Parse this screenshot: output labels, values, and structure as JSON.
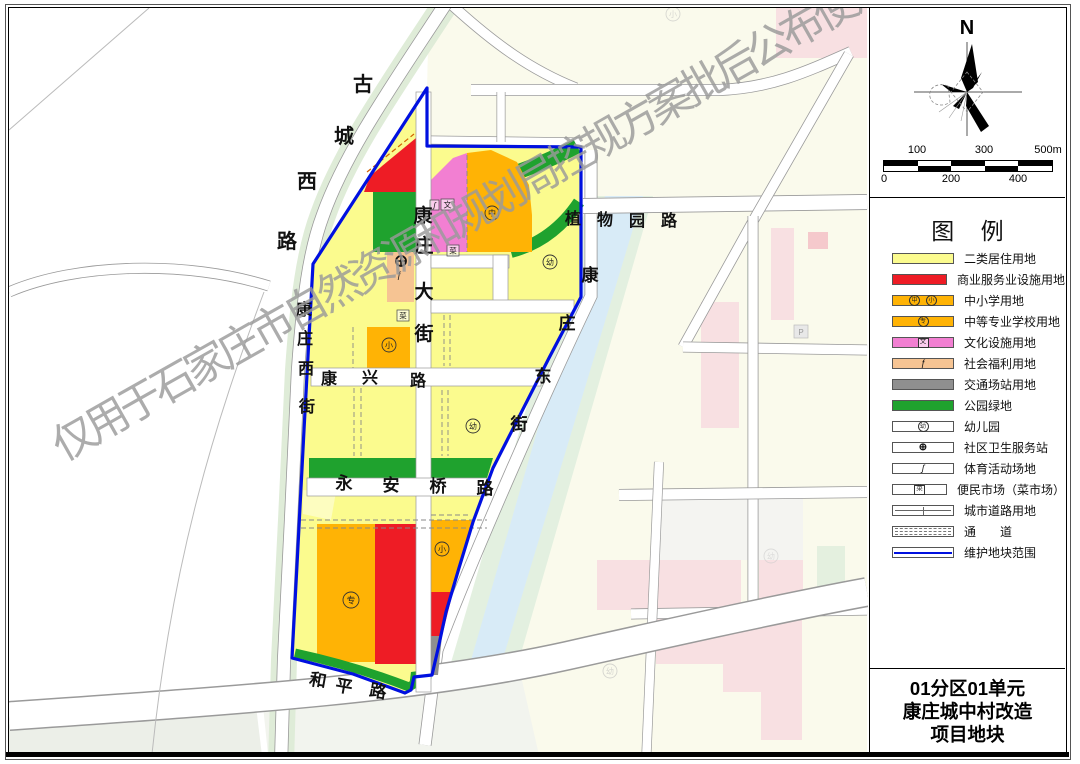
{
  "watermark": "仅用于石家庄市自然资源和规划局控规方案批后公布使用",
  "compass": {
    "north_label": "N"
  },
  "scalebar": {
    "top": [
      "100",
      "300",
      "500m"
    ],
    "bottom": [
      "0",
      "200",
      "400"
    ]
  },
  "colors": {
    "residential": "#FBFB8E",
    "residential_light": "#FDFDC0",
    "commercial": "#EE1C25",
    "school": "#FFB305",
    "cultural": "#F27FD2",
    "welfare": "#F6C493",
    "transport": "#8F8F8F",
    "park": "#1FA22E",
    "boundary": "#0010E0",
    "bg_cream": "#FAFAEC",
    "bg_pink": "#F8E0E2",
    "bg_pink_deep": "#F5C9CC",
    "bg_green": "#E4F0DF",
    "river_bank": "#E3F0E0",
    "river_water": "#D8EBF7",
    "bg_gray_green": "#ECEFE8"
  },
  "legend": {
    "title": "图  例",
    "items": [
      {
        "label": "二类居住用地",
        "syms": []
      },
      {
        "label": "商业服务业设施用地",
        "syms": []
      },
      {
        "label": "中小学用地",
        "syms": [
          "中",
          "小"
        ]
      },
      {
        "label": "中等专业学校用地",
        "syms": [
          "专"
        ]
      },
      {
        "label": "文化设施用地",
        "syms": [
          "文"
        ]
      },
      {
        "label": "社会福利用地",
        "syms": [
          "ƒ"
        ]
      },
      {
        "label": "交通场站用地",
        "syms": []
      },
      {
        "label": "公园绿地",
        "syms": []
      },
      {
        "label": "幼儿园",
        "syms": [
          "幼"
        ]
      },
      {
        "label": "社区卫生服务站",
        "syms": [
          "⊕"
        ]
      },
      {
        "label": "体育活动场地",
        "syms": [
          "ʃ"
        ]
      },
      {
        "label": "便民市场（菜市场）",
        "syms": [
          "菜"
        ]
      },
      {
        "label": "城市道路用地",
        "syms": []
      },
      {
        "label": "通　　道",
        "syms": []
      },
      {
        "label": "维护地块范围",
        "syms": []
      }
    ]
  },
  "title_block": {
    "line1": "01分区01单元",
    "line2": "康庄城中村改造",
    "line3": "项目地块"
  },
  "map": {
    "road_labels": [
      {
        "name": "古城西路"
      },
      {
        "name": "康庄大街"
      },
      {
        "name": "康庄西街"
      },
      {
        "name": "康兴路"
      },
      {
        "name": "永安桥路"
      },
      {
        "name": "康庄东街"
      },
      {
        "name": "植物园路"
      },
      {
        "name": "和平路"
      }
    ],
    "symbols": [
      {
        "char": "中"
      },
      {
        "char": "小"
      },
      {
        "char": "幼"
      },
      {
        "char": "幼"
      },
      {
        "char": "专"
      },
      {
        "char": "小"
      },
      {
        "char": "小"
      },
      {
        "char": "幼"
      },
      {
        "char": "幼"
      }
    ],
    "boxes": [
      {
        "char": "文"
      },
      {
        "char": "ʃ"
      },
      {
        "char": "菜"
      },
      {
        "char": "菜"
      },
      {
        "char": "P"
      }
    ],
    "special": {
      "welfare_glyph": "ƒ"
    }
  }
}
